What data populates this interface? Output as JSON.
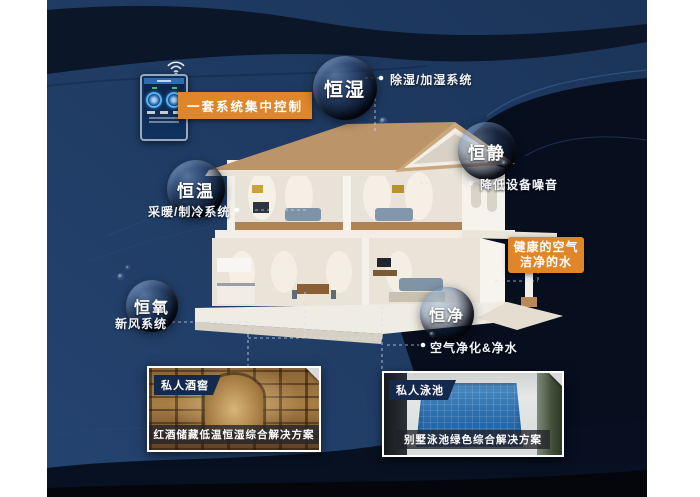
{
  "colors": {
    "background_navy": "#1f3a63",
    "band_dark": "#081120",
    "accent_orange": "#e0862a",
    "label_text": "#ffffff",
    "photo_tag_bg": "#15294e"
  },
  "control_panel": {
    "label": "一套系统集中控制"
  },
  "bubbles": {
    "humidity": {
      "label": "恒湿",
      "sub": "除湿/加湿系统"
    },
    "quiet": {
      "label": "恒静",
      "sub": "降低设备噪音"
    },
    "temperature": {
      "label": "恒温",
      "sub": "采暖/制冷系统"
    },
    "oxygen": {
      "label": "恒氧",
      "sub": "新风系统"
    },
    "purity": {
      "label": "恒净",
      "sub": "空气净化&净水"
    }
  },
  "highlight": {
    "line1": "健康的空气",
    "line2": "洁净的水"
  },
  "photos": {
    "cellar": {
      "tag": "私人酒窖",
      "caption": "红酒储藏低温恒湿综合解决方案"
    },
    "pool": {
      "tag": "私人泳池",
      "caption": "别墅泳池绿色综合解决方案"
    }
  }
}
